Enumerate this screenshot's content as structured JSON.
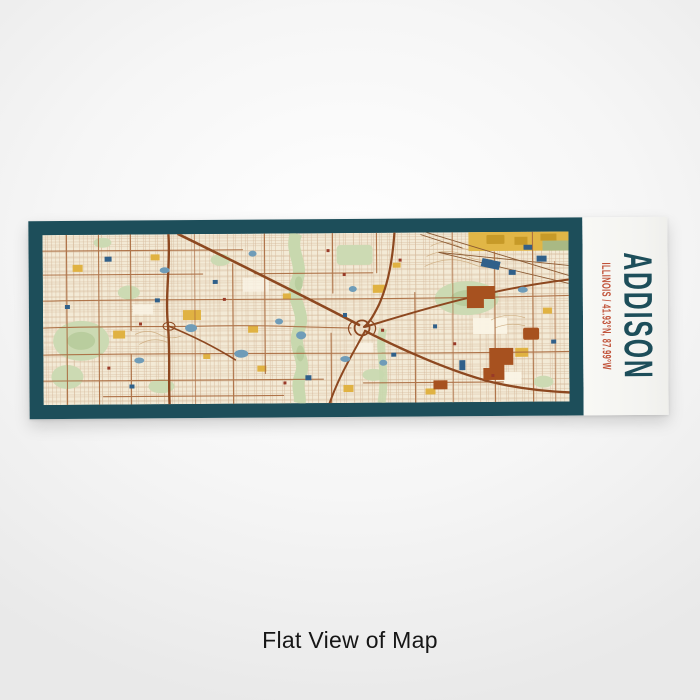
{
  "caption": {
    "text": "Flat View of Map"
  },
  "print": {
    "city": "ADDISON",
    "subtitle": "ILLINOIS / 41.93°N, 87.99°W",
    "view_label": "flat",
    "colors": {
      "frame": "#1d4e5a",
      "title_text": "#1d4e5a",
      "subtitle_text": "#c05138",
      "panel": "#f7f7f4",
      "map_background": "#f3ead6",
      "map_fine_streets": "#d4b796",
      "map_major_roads": "#a96a3e",
      "map_highways": "#8d4820",
      "map_parks": "#ccdab3",
      "map_creek": "#c8d8ae",
      "map_water": "#6f9cb8",
      "map_buildings_blue": "#30608a",
      "map_accent_yellow": "#e1b646",
      "map_accent_gold": "#c79a28",
      "map_accent_rust": "#a7511f",
      "map_accent_red": "#993a28",
      "map_contours": "#ccab7e"
    }
  }
}
